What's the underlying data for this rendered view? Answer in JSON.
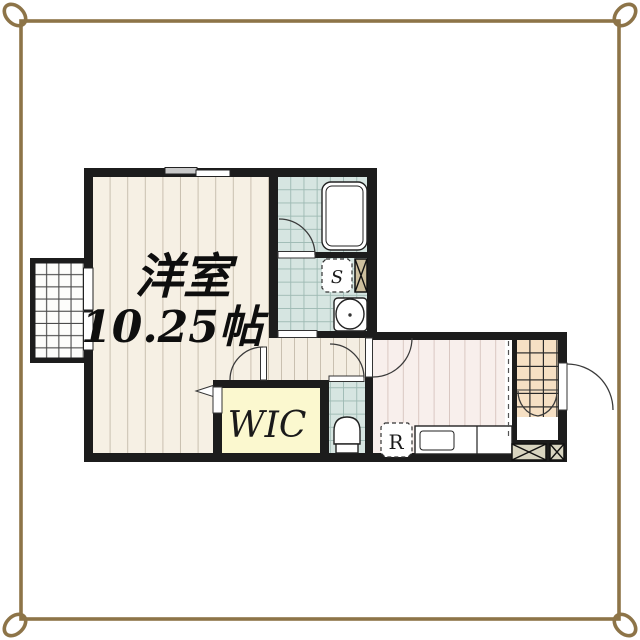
{
  "document": {
    "kind": "apartment-floor-plan"
  },
  "rooms": {
    "main_room": {
      "name": "洋室",
      "size_label": "10.25帖"
    },
    "walk_in_closet": {
      "label": "WIC"
    },
    "washer_space": {
      "label": "S"
    },
    "refrigerator_space": {
      "label": "R"
    }
  },
  "colors": {
    "frame_color": "#8d7448",
    "wall_color": "#1c1c1c",
    "main_floor": "#f6f0e4",
    "plank_line": "#c9c0b0",
    "kitchen_floor": "#f8efec",
    "kitchen_line": "#d9c7c2",
    "tile_teal": "#d6e5e1",
    "tile_teal_line": "#9db9b3",
    "tile_entry": "#f6e0c4",
    "tile_entry_line": "#2a2a2a",
    "wic_color": "#fbf8cf",
    "hatch_fill": "#d8d4c0",
    "hatch_tan": "#cdbf9e"
  }
}
